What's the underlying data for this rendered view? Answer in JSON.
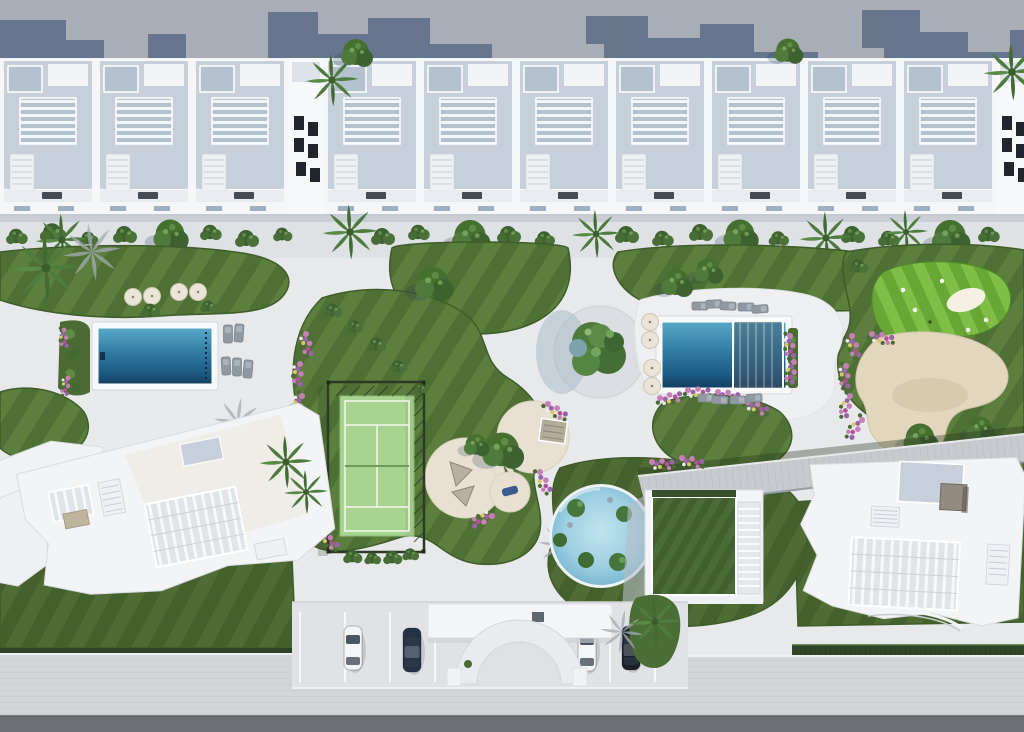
{
  "meta": {
    "type": "architectural-aerial-3d-render",
    "description": "Top-down aerial 3D render of a white residential complex: a row of townhouses with rooftop terraces at top, central landscaped gardens with two rectangular lap pools, a circular lagoon pool, a padel court, a putting green with sand bunker, circular lounge plazas, angled white apartment buildings at the bottom corners, street-side parking with an arched entrance canopy, and an asphalt road along the bottom edge."
  },
  "palette": {
    "ground": "#e7e9eb",
    "band": "#a9aeb6",
    "band_shadow": "#5e7089",
    "wall": "#eef1f4",
    "wall_bright": "#f6f8fa",
    "roof": "#c7d0da",
    "roof_dark": "#b4c1cf",
    "facade_shadow": "#c3c9d1",
    "promenade": "#dfe2e5",
    "plaza_pave": "#dbdee2",
    "lawn": "#4f7034",
    "lawn_stripe": "#5d7f3e",
    "lawn_dark": "#3f5c2a",
    "lawn_deep": "#44602c",
    "lawn_deep_stripe": "#4e6c33",
    "putting": "#68a736",
    "putting_stripe": "#7fbf47",
    "tree": "#3e6130",
    "tree_light": "#5f8a47",
    "palm": "#4d7c3e",
    "hedge": "#31452a",
    "pool_top": "#59a8c6",
    "pool_mid": "#2f7ba3",
    "pool_deep": "#123f60",
    "lagoon": "#9fd0e2",
    "lagoon_light": "#c2e2ee",
    "sand": "#e2d6bc",
    "sand_shadow": "#cfc1a4",
    "beige_plaza": "#e8e1d1",
    "court": "#a8d491",
    "court_line": "#f2f8ee",
    "fence": "#2c3a26",
    "flower_pink": "#c77fb7",
    "flower_purple": "#9b63ac",
    "flower_magenta": "#b5519b",
    "flower_yellow": "#d9c967",
    "road": "#6b6e72",
    "sidewalk": "#d2d5d8",
    "parking": "#e0e2e5",
    "boardwalk": "#c7cace",
    "car_white": "#f2f4f6",
    "car_navy": "#243247",
    "car_black": "#1b212a",
    "lounger": "#9099a2",
    "umbrella": "#eae5d8"
  },
  "features": {
    "townhouse_units": 10,
    "lap_pools": 2,
    "lagoon_pool": 1,
    "padel_court": 1,
    "putting_green": 1,
    "sand_bunker": 1,
    "lounge_circles": 3,
    "parked_cars": 4,
    "entrance_arch": 1
  }
}
